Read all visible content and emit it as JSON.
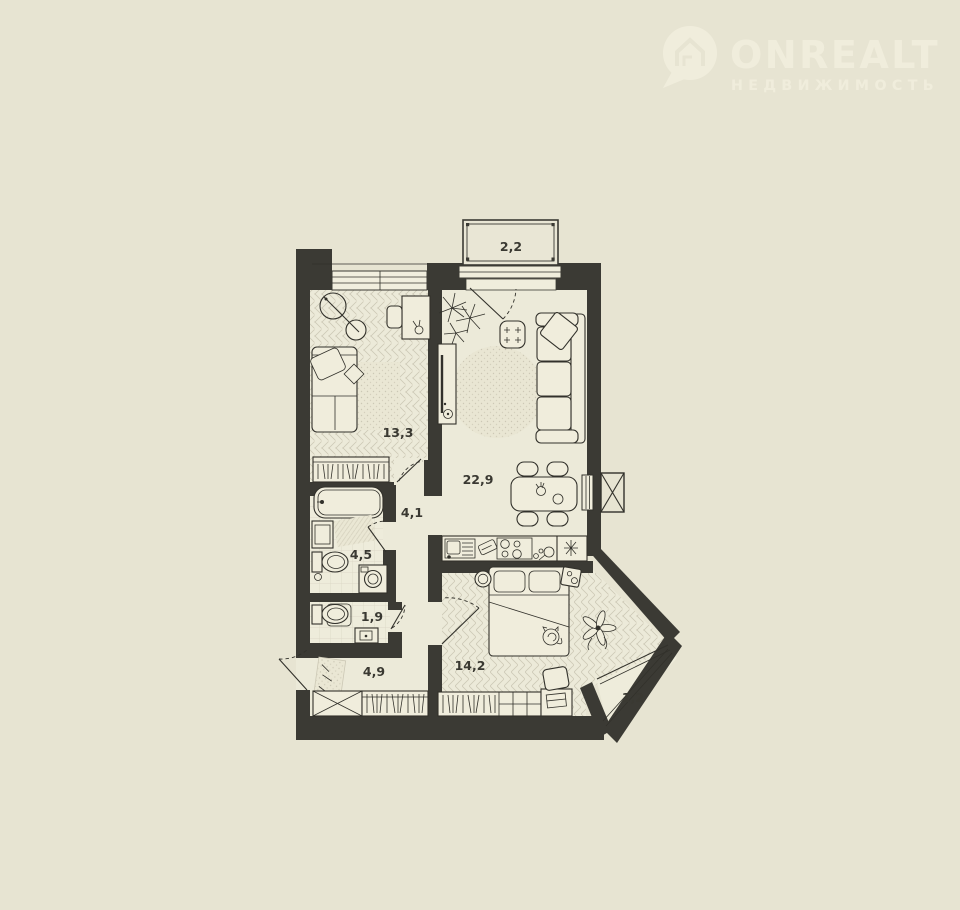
{
  "watermark": {
    "brand": "ONREALT",
    "tagline": "НЕДВИЖИМОСТЬ"
  },
  "floor_plan": {
    "rooms": [
      {
        "id": "balcony-top",
        "label": "2,2"
      },
      {
        "id": "bedroom-main",
        "label": "13,3"
      },
      {
        "id": "living-kitchen",
        "label": "22,9"
      },
      {
        "id": "hall-inner",
        "label": "4,1"
      },
      {
        "id": "bathroom",
        "label": "4,5"
      },
      {
        "id": "wc",
        "label": "1,9"
      },
      {
        "id": "hall-entry",
        "label": "4,9"
      },
      {
        "id": "bedroom-second",
        "label": "14,2"
      },
      {
        "id": "balcony-bottom",
        "label": "1,2"
      }
    ]
  },
  "colors": {
    "background": "#e7e4d2",
    "wall": "#3b3a34",
    "floor": "#ecead9",
    "watermark": "#f2efde",
    "line": "#32312b"
  }
}
